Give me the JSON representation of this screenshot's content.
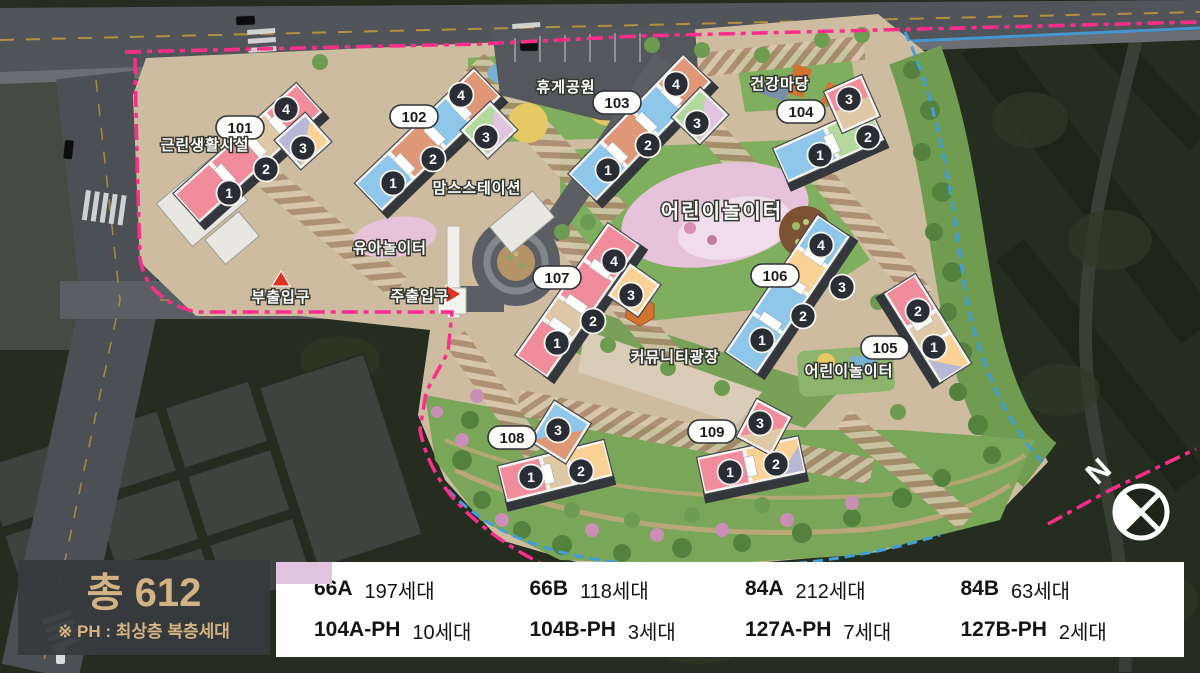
{
  "palette": {
    "p66A": "#f18c9c",
    "p66B": "#fbd295",
    "p84A": "#8ec7e9",
    "p84B": "#b4d99e",
    "p104A": "#dec8a6",
    "p104B": "#b7b7d6",
    "p127A": "#df9778",
    "p127B": "#dfc3df",
    "boundary_pink": "#ff2d8a",
    "boundary_blue": "#3f9fdd"
  },
  "summary": {
    "total": "총 612",
    "note": "※ PH : 최상층 복층세대"
  },
  "legend": {
    "items": [
      {
        "code": "66A",
        "count": "197세대",
        "color": "#f18c9c"
      },
      {
        "code": "66B",
        "count": "118세대",
        "color": "#fbd295"
      },
      {
        "code": "84A",
        "count": "212세대",
        "color": "#8ec7e9"
      },
      {
        "code": "84B",
        "count": "63세대",
        "color": "#b4d99e"
      },
      {
        "code": "104A-PH",
        "count": "10세대",
        "color": "#dec8a6"
      },
      {
        "code": "104B-PH",
        "count": "3세대",
        "color": "#b7b7d6"
      },
      {
        "code": "127A-PH",
        "count": "7세대",
        "color": "#df9778"
      },
      {
        "code": "127B-PH",
        "count": "2세대",
        "color": "#dfc3df"
      }
    ]
  },
  "map": {
    "compass_n": "N",
    "labels": {
      "facility": "근린생활시설",
      "rest_park": "휴게공원",
      "health_yard": "건강마당",
      "moms_station": "맘스스테이션",
      "kids_play_upper": "어린이놀이터",
      "toddler_play": "유아놀이터",
      "sub_entrance": "부출입구",
      "main_entrance": "주출입구",
      "community_plaza": "커뮤니티광장",
      "kids_play_lower": "어린이놀이터"
    },
    "buildings": [
      {
        "id": "101",
        "units": [
          "1",
          "2",
          "3",
          "4"
        ]
      },
      {
        "id": "102",
        "units": [
          "1",
          "2",
          "3",
          "4"
        ]
      },
      {
        "id": "103",
        "units": [
          "1",
          "2",
          "3",
          "4"
        ]
      },
      {
        "id": "104",
        "units": [
          "1",
          "2",
          "3"
        ]
      },
      {
        "id": "105",
        "units": [
          "1",
          "2"
        ]
      },
      {
        "id": "106",
        "units": [
          "1",
          "2",
          "3",
          "4"
        ]
      },
      {
        "id": "107",
        "units": [
          "1",
          "2",
          "3",
          "4"
        ]
      },
      {
        "id": "108",
        "units": [
          "1",
          "2",
          "3"
        ]
      },
      {
        "id": "109",
        "units": [
          "1",
          "2",
          "3"
        ]
      }
    ]
  }
}
